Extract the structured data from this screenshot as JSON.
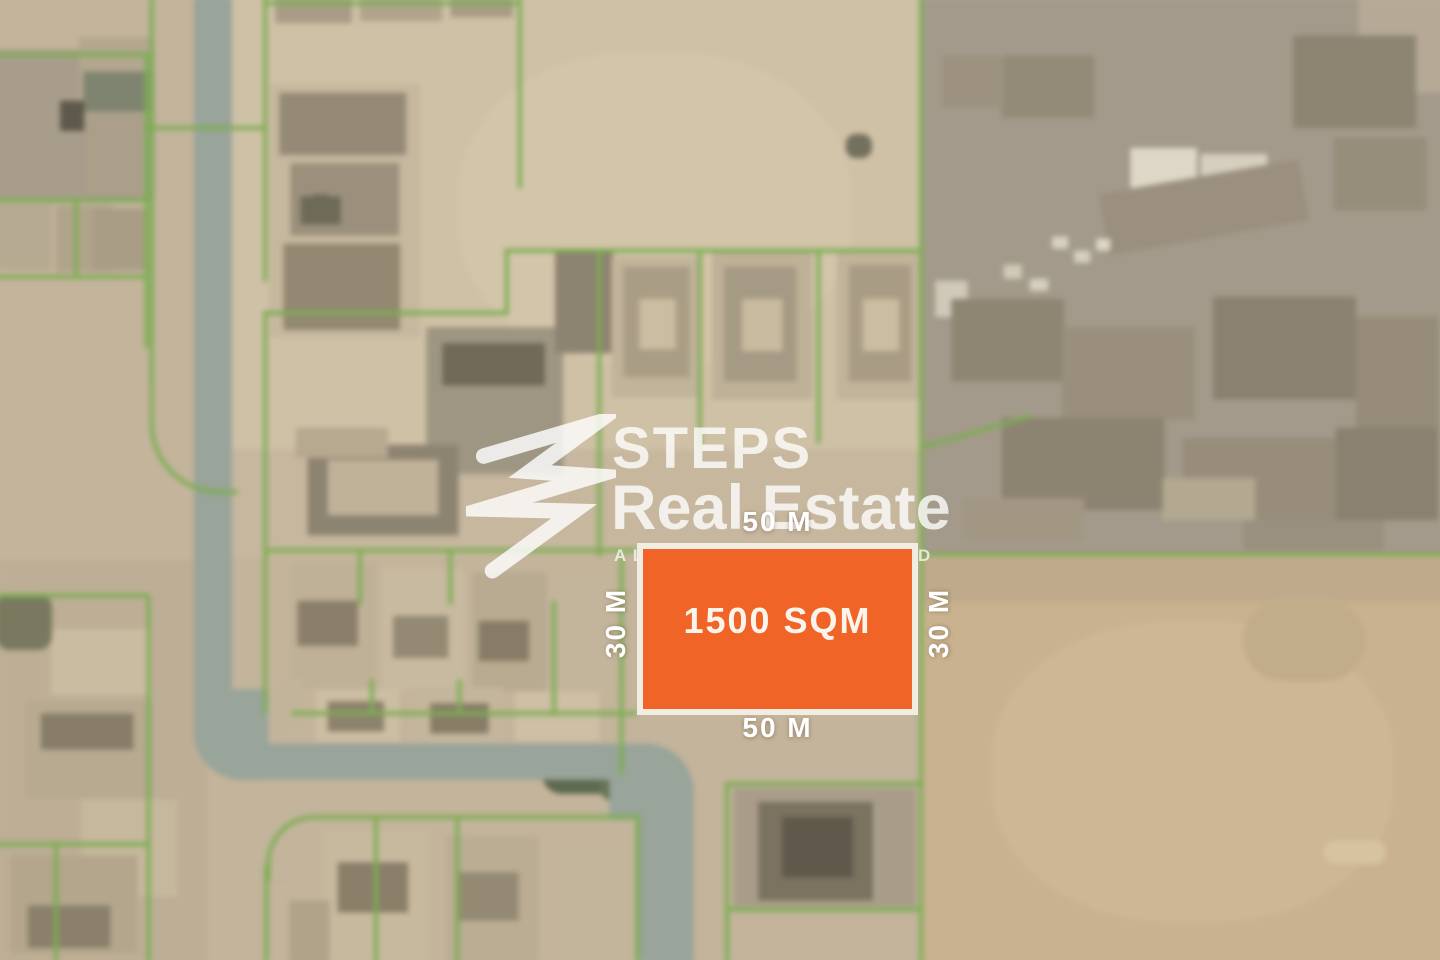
{
  "watermark": {
    "brand_line1": "STEPS",
    "brand_line2": "Real Estate",
    "tagline": "ALWAYS A STEP AHEAD",
    "icon": "steps-swoosh-icon"
  },
  "plot": {
    "area_label": "1500 SQM",
    "dim_top": "50 M",
    "dim_bottom": "50 M",
    "dim_left": "30 M",
    "dim_right": "30 M"
  },
  "colors": {
    "plot_fill": "#F06527",
    "plot_border": "#F2EDE2",
    "plot_text": "#FAF5EC",
    "dim_text": "#FFFFFF",
    "parcel_line": "#7CAD52",
    "road": "#99A49A",
    "sand_base": "#C3B49B",
    "watermark_white": "#FFFFFF"
  },
  "map_layout": {
    "regions": [
      [
        233,
        0,
        687,
        450,
        "#cfc1a6"
      ],
      [
        460,
        55,
        390,
        310,
        "#d3c5aa",
        0,
        "45%"
      ],
      [
        920,
        0,
        520,
        556,
        "#a49a8b"
      ],
      [
        1355,
        0,
        85,
        95,
        "#b6aa97"
      ],
      [
        920,
        556,
        520,
        404,
        "#c9b28f"
      ],
      [
        920,
        558,
        520,
        44,
        "#bfab8c"
      ],
      [
        990,
        620,
        400,
        300,
        "#cdb794",
        0,
        "45%"
      ],
      [
        0,
        560,
        210,
        400,
        "#bdae95"
      ],
      [
        233,
        450,
        687,
        106,
        "#c6b79e"
      ],
      [
        269,
        556,
        350,
        160,
        "#c3b49a"
      ]
    ],
    "buildings": [
      [
        0,
        52,
        158,
        150,
        "#a89d8b"
      ],
      [
        83,
        40,
        72,
        76,
        "#b3a78f"
      ],
      [
        87,
        74,
        66,
        40,
        "#7f8470"
      ],
      [
        64,
        103,
        24,
        30,
        "#5f594b"
      ],
      [
        90,
        118,
        62,
        78,
        "#ab9f8a"
      ],
      [
        0,
        205,
        56,
        66,
        "#b6aa92"
      ],
      [
        60,
        207,
        56,
        66,
        "#b0a48c"
      ],
      [
        96,
        210,
        52,
        62,
        "#a99d86"
      ],
      [
        272,
        86,
        150,
        252,
        "#c6b89e"
      ],
      [
        282,
        95,
        126,
        62,
        "#948a76"
      ],
      [
        293,
        165,
        108,
        72,
        "#9b907b"
      ],
      [
        286,
        245,
        116,
        86,
        "#938871"
      ],
      [
        303,
        198,
        40,
        28,
        "#6e6a58"
      ],
      [
        278,
        0,
        76,
        26,
        "#a89c86"
      ],
      [
        362,
        0,
        82,
        24,
        "#b0a48c"
      ],
      [
        452,
        0,
        62,
        20,
        "#a89c86"
      ],
      [
        308,
        196,
        30,
        26,
        "#6e6a58",
        0,
        "12px"
      ],
      [
        845,
        136,
        26,
        24,
        "#73705e",
        0,
        "10px"
      ],
      [
        428,
        328,
        136,
        146,
        "#9e9682"
      ],
      [
        444,
        344,
        102,
        42,
        "#716a58"
      ],
      [
        556,
        250,
        58,
        104,
        "#8d8371"
      ],
      [
        612,
        258,
        90,
        140,
        "#c2b49a"
      ],
      [
        624,
        268,
        66,
        110,
        "#a99d86"
      ],
      [
        640,
        300,
        36,
        50,
        "#cbbda1"
      ],
      [
        712,
        254,
        100,
        146,
        "#bfb197"
      ],
      [
        724,
        268,
        72,
        114,
        "#a59a84"
      ],
      [
        742,
        300,
        40,
        52,
        "#c9bb9f"
      ],
      [
        836,
        250,
        84,
        150,
        "#c2b49a"
      ],
      [
        848,
        266,
        62,
        116,
        "#a89c85"
      ],
      [
        862,
        300,
        36,
        52,
        "#cbbda1"
      ],
      [
        310,
        445,
        150,
        90,
        "#8d8371"
      ],
      [
        330,
        460,
        110,
        55,
        "#c0b298"
      ],
      [
        298,
        428,
        92,
        30,
        "#b6a990"
      ],
      [
        292,
        562,
        86,
        126,
        "#bfb197"
      ],
      [
        384,
        568,
        82,
        122,
        "#c8baa0"
      ],
      [
        474,
        572,
        74,
        118,
        "#b8ab91"
      ],
      [
        556,
        578,
        62,
        106,
        "#c3b59b"
      ],
      [
        300,
        600,
        60,
        45,
        "#8a7f6a"
      ],
      [
        395,
        615,
        55,
        42,
        "#948a74"
      ],
      [
        480,
        620,
        50,
        40,
        "#877c66"
      ],
      [
        235,
        682,
        74,
        54,
        "#c2b49a",
        -8
      ],
      [
        318,
        688,
        84,
        52,
        "#ccbea3"
      ],
      [
        412,
        686,
        92,
        54,
        "#c4b69c"
      ],
      [
        516,
        690,
        84,
        50,
        "#cebfa5"
      ],
      [
        330,
        700,
        56,
        30,
        "#8d826c"
      ],
      [
        432,
        702,
        58,
        30,
        "#877d67"
      ],
      [
        325,
        828,
        105,
        130,
        "#c7b99e"
      ],
      [
        448,
        834,
        92,
        126,
        "#bbad93"
      ],
      [
        552,
        842,
        76,
        118,
        "#c3b59b"
      ],
      [
        340,
        860,
        70,
        50,
        "#8a7f69"
      ],
      [
        460,
        870,
        60,
        48,
        "#948a74"
      ],
      [
        292,
        898,
        40,
        62,
        "#b0a389"
      ],
      [
        55,
        628,
        100,
        66,
        "#cabca1"
      ],
      [
        30,
        700,
        126,
        96,
        "#b7aa90"
      ],
      [
        45,
        712,
        92,
        36,
        "#877d68"
      ],
      [
        85,
        798,
        96,
        96,
        "#c6b89d"
      ],
      [
        15,
        853,
        126,
        97,
        "#b3a68c"
      ],
      [
        32,
        903,
        82,
        42,
        "#8a806b"
      ],
      [
        0,
        593,
        56,
        56,
        "#79795f",
        0,
        "14px"
      ],
      [
        733,
        786,
        182,
        118,
        "#a99d89"
      ],
      [
        758,
        800,
        114,
        98,
        "#7b7260"
      ],
      [
        782,
        815,
        70,
        60,
        "#5f584b"
      ],
      [
        543,
        750,
        86,
        42,
        "#5d6950",
        0,
        "20px"
      ],
      [
        600,
        766,
        62,
        34,
        "#667355",
        0,
        "16px"
      ],
      [
        1000,
        58,
        92,
        62,
        "#948a78"
      ],
      [
        1290,
        38,
        122,
        92,
        "#8d8472"
      ],
      [
        1330,
        140,
        92,
        72,
        "#978d7b"
      ],
      [
        940,
        58,
        62,
        52,
        "#9d9280"
      ],
      [
        1128,
        150,
        66,
        60,
        "#ded7c7"
      ],
      [
        1198,
        156,
        66,
        54,
        "#d6cfbf"
      ],
      [
        934,
        282,
        32,
        36,
        "#d0c9b9"
      ],
      [
        950,
        300,
        112,
        82,
        "#8f8573"
      ],
      [
        1060,
        328,
        132,
        92,
        "#9a8f7c"
      ],
      [
        1210,
        298,
        142,
        102,
        "#8a8170"
      ],
      [
        1352,
        318,
        82,
        122,
        "#958b78"
      ],
      [
        1000,
        418,
        162,
        92,
        "#8d8371"
      ],
      [
        1180,
        438,
        152,
        82,
        "#978d7a"
      ],
      [
        1332,
        428,
        102,
        92,
        "#8a8170"
      ],
      [
        1100,
        178,
        202,
        62,
        "#9b9080",
        -10
      ],
      [
        1050,
        238,
        16,
        12,
        "#d8d2c2"
      ],
      [
        1072,
        252,
        16,
        12,
        "#d5cfbf"
      ],
      [
        1094,
        240,
        14,
        12,
        "#dcd6c6"
      ],
      [
        1002,
        266,
        18,
        14,
        "#d0cab8"
      ],
      [
        1028,
        280,
        18,
        12,
        "#d6d0c0"
      ],
      [
        1160,
        478,
        92,
        42,
        "#b3a890"
      ],
      [
        960,
        498,
        122,
        42,
        "#a29783"
      ],
      [
        1240,
        520,
        140,
        30,
        "#9a9080"
      ],
      [
        1320,
        838,
        62,
        24,
        "#d6c3a0",
        0,
        "12px"
      ],
      [
        1240,
        598,
        122,
        82,
        "#c2ad8b",
        0,
        "40px"
      ]
    ],
    "roads": [
      [
        197,
        0,
        38,
        712,
        "#99a49a"
      ],
      [
        197,
        688,
        74,
        90,
        "#99a49a",
        0,
        "0 0 0 48px"
      ],
      [
        240,
        742,
        412,
        36,
        "#99a49a"
      ],
      [
        610,
        742,
        84,
        76,
        "#99a49a",
        0,
        "0 48px 0 0"
      ],
      [
        638,
        806,
        56,
        154,
        "#99a49a"
      ]
    ],
    "green_h": [
      [
        920,
        552,
        520
      ],
      [
        268,
        548,
        369
      ],
      [
        0,
        55,
        150
      ],
      [
        148,
        128,
        120
      ],
      [
        0,
        200,
        150
      ],
      [
        0,
        276,
        150
      ],
      [
        266,
        312,
        244
      ],
      [
        508,
        250,
        412
      ],
      [
        266,
        4,
        256
      ],
      [
        294,
        710,
        344
      ],
      [
        320,
        813,
        318
      ],
      [
        727,
        780,
        192
      ],
      [
        727,
        905,
        192
      ],
      [
        0,
        593,
        152
      ],
      [
        0,
        840,
        150
      ]
    ],
    "green_v": [
      [
        918,
        0,
        960
      ],
      [
        620,
        556,
        216
      ],
      [
        266,
        0,
        283
      ],
      [
        266,
        312,
        400
      ],
      [
        519,
        0,
        190
      ],
      [
        148,
        55,
        294
      ],
      [
        78,
        200,
        80
      ],
      [
        506,
        250,
        66
      ],
      [
        598,
        252,
        304
      ],
      [
        698,
        254,
        192
      ],
      [
        816,
        252,
        192
      ],
      [
        360,
        548,
        56
      ],
      [
        450,
        548,
        56
      ],
      [
        372,
        678,
        36
      ],
      [
        459,
        678,
        36
      ],
      [
        553,
        600,
        112
      ],
      [
        267,
        862,
        98
      ],
      [
        376,
        813,
        147
      ],
      [
        457,
        813,
        147
      ],
      [
        636,
        813,
        147
      ],
      [
        725,
        780,
        180
      ],
      [
        150,
        595,
        365
      ],
      [
        58,
        840,
        120
      ],
      [
        153,
        0,
        382
      ]
    ],
    "green_rot": [
      [
        918,
        430,
        114,
        -16
      ]
    ],
    "green_corners": [
      [
        153,
        378,
        84,
        112,
        "bl",
        70
      ],
      [
        269,
        813,
        58,
        62,
        "tl",
        48
      ]
    ]
  }
}
